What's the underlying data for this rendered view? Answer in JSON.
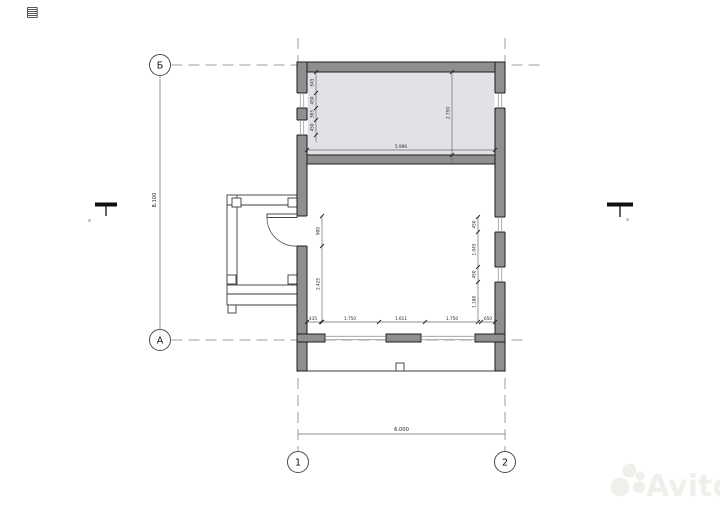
{
  "axes": {
    "rows": [
      {
        "label": "Б"
      },
      {
        "label": "А"
      }
    ],
    "cols": [
      {
        "label": "1"
      },
      {
        "label": "2"
      }
    ],
    "row_span_dim": "8.100",
    "col_span_dim": "6.000"
  },
  "plan": {
    "attic_room": {
      "width_dim": "5.996",
      "height_dim": "2.750",
      "left_chain": [
        "645",
        "450",
        "365",
        "450"
      ]
    },
    "main_room": {
      "door_chain": [
        "900",
        "2.425"
      ],
      "right_chain": [
        "450",
        "1.045",
        "450",
        "1.188"
      ],
      "bottom_chain": [
        "435",
        "1.750",
        "1.611",
        "1.750",
        "650"
      ]
    }
  },
  "colors": {
    "wall_fill": "#8f8f8f",
    "wall_outline": "#1c1c1c",
    "room_shade": "#e2e2e6",
    "axis_line": "#9e9e9e",
    "dim_text": "#222222",
    "watermark": "#f1efec"
  },
  "corner_icon": {
    "glyph": "▤"
  },
  "watermark": {
    "brand": "Avito"
  }
}
